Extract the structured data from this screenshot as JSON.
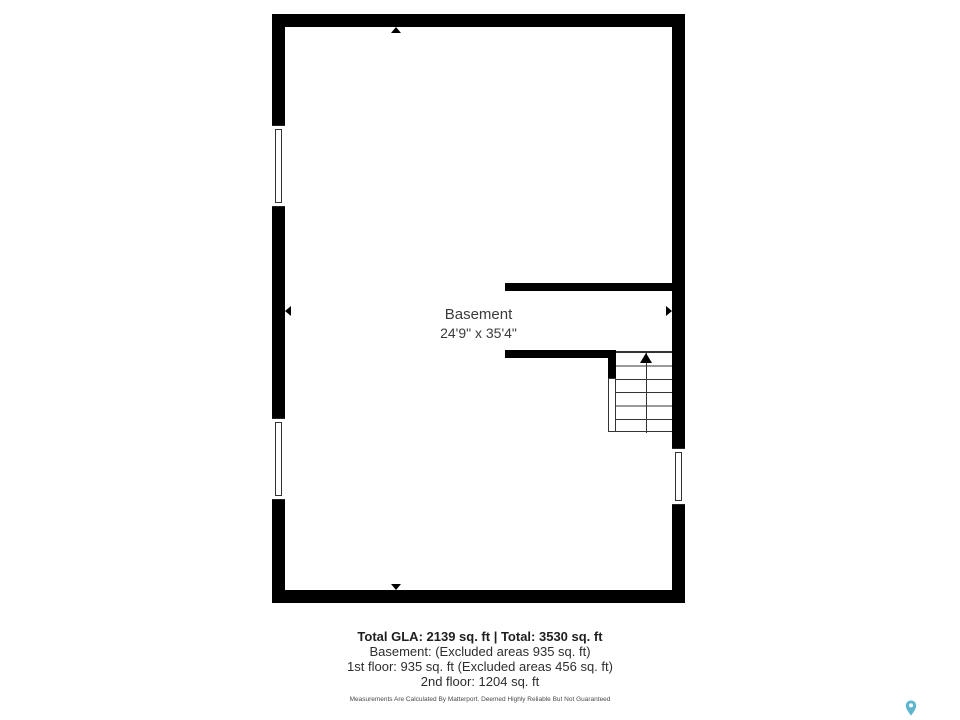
{
  "page": {
    "background": "#ffffff"
  },
  "floor_plan": {
    "room": {
      "label": "Basement",
      "dimensions": "24'9\" x 35'4\""
    },
    "icons": {
      "stairs_direction_icon": "arrow-up",
      "dimension_marker_icons": [
        "top",
        "bottom",
        "left",
        "right"
      ],
      "window_symbols": [
        "left-upper",
        "left-lower",
        "right-lower"
      ]
    },
    "colors": {
      "wall": "#000000",
      "line": "#333333",
      "label_text": "#3b3b3b"
    }
  },
  "footer": {
    "summary_bold": "Total GLA: 2139 sq. ft | Total: 3530 sq. ft",
    "lines": [
      "Basement: (Excluded areas 935 sq. ft)",
      "1st floor: 935 sq. ft (Excluded areas 456 sq. ft)",
      "2nd floor: 1204 sq. ft"
    ],
    "disclaimer": "Measurements Are Calculated By Matterport. Deemed Highly Reliable But Not Guaranteed"
  },
  "branding": {
    "map_pin_icon": "map-pin",
    "pin_color": "#5db6cd"
  }
}
